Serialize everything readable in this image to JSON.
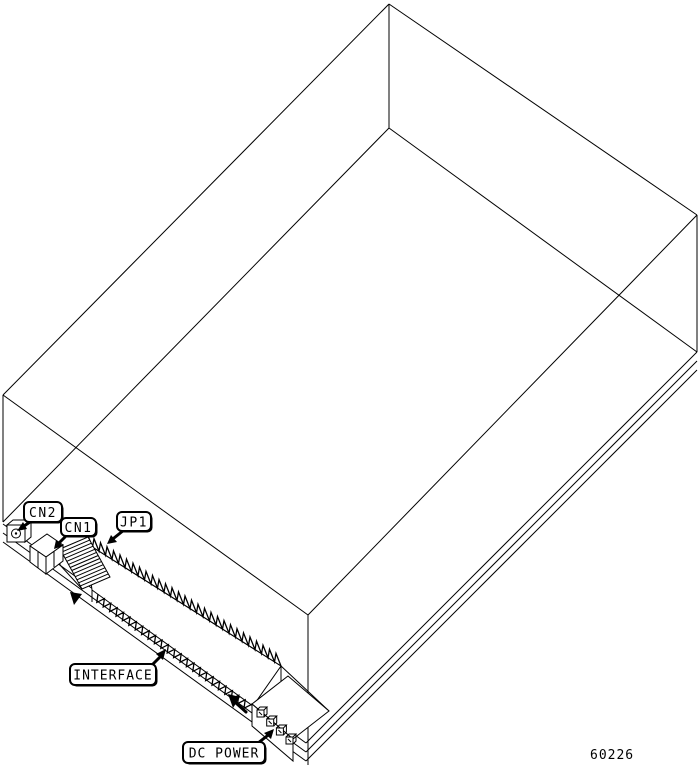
{
  "figure": {
    "callouts": {
      "cn2": "CN2",
      "cn1": "CN1",
      "jp1": "JP1",
      "interface": "INTERFACE",
      "dc_power": "DC POWER"
    },
    "figure_number": "60226",
    "colors": {
      "line": "#000000",
      "background": "#ffffff"
    }
  }
}
